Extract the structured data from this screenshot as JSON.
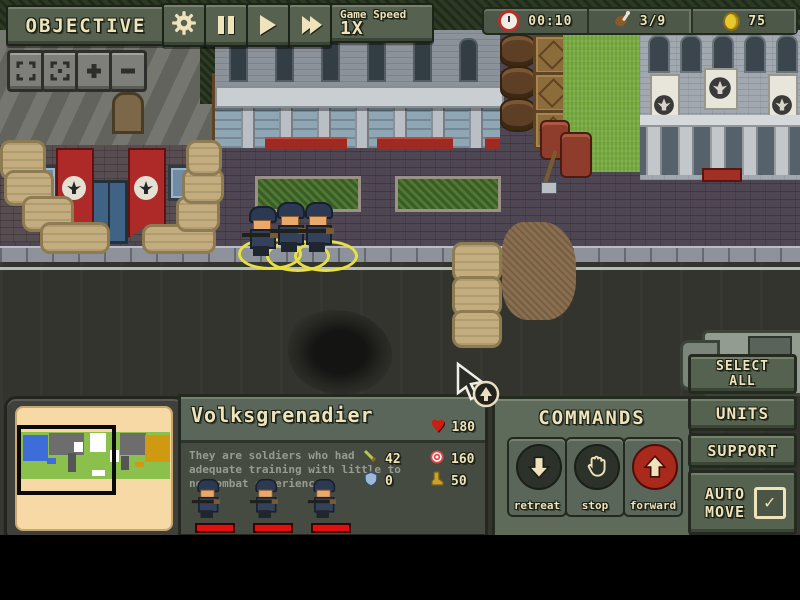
{
  "hud": {
    "objective": "OBJECTIVE",
    "game_speed_label": "Game Speed",
    "game_speed_value": "1X",
    "resources": {
      "time": "00:10",
      "grenades": "3/9",
      "coins": "75"
    }
  },
  "unit_panel": {
    "title": "Volksgrenadier",
    "health": "180",
    "description": "They are soldiers who had adequate training with little to no combat experience",
    "attack": "42",
    "range": "160",
    "armor": "0",
    "cost": "50"
  },
  "commands": {
    "title": "COMMANDS",
    "retreat_label": "retreat",
    "stop_label": "stop",
    "forward_label": "forward"
  },
  "side_buttons": {
    "select_all": "SELECT ALL",
    "units": "UNITS",
    "support": "SUPPORT",
    "auto_move": "AUTO MOVE",
    "auto_move_check": "✓"
  },
  "icons": {
    "heart": "♥",
    "check": "✓"
  },
  "colors": {
    "hud_olive": "#57614f",
    "cream_text": "#efe3bb",
    "forward_red": "#a9291d",
    "banner_red": "#ae2a28",
    "selection_yellow": "#e6e040",
    "health_red": "#cf1c10",
    "minimap_cream": "#f6d9a4",
    "minimap_green": "#8cc04d",
    "grass_green": "#79ad42",
    "road_gray": "#34342e"
  }
}
